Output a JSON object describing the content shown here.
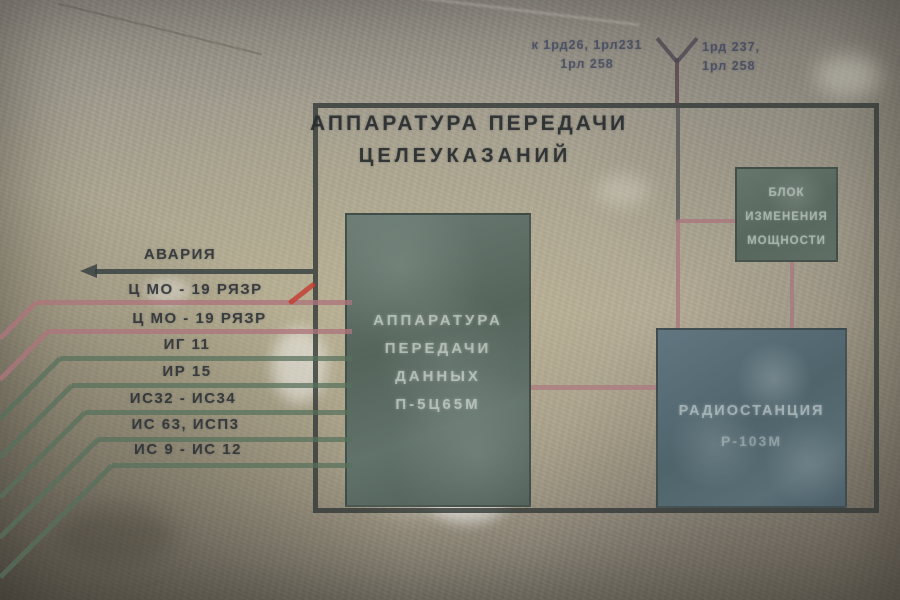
{
  "meta": {
    "description": "Photograph of a schematic diagram stencil-painted on a concrete bunker wall",
    "language": "Russian"
  },
  "title": {
    "line1": "АППАРАТУРА ПЕРЕДАЧИ",
    "line2": "ЦЕЛЕУКАЗАНИЙ"
  },
  "antenna_labels": {
    "left": {
      "line1": "к 1рд26, 1рл231",
      "line2": "1рл 258"
    },
    "right": {
      "line1": "1рд 237,",
      "line2": "1рл 258"
    }
  },
  "boxes": {
    "data_apparatus": {
      "lines": [
        "АППАРАТУРА",
        "ПЕРЕДАЧИ",
        "ДАННЫХ",
        "П-5Ц65М"
      ]
    },
    "power_block": {
      "lines": [
        "БЛОК",
        "ИЗМЕНЕНИЯ",
        "МОЩНОСТИ"
      ]
    },
    "radio_station": {
      "lines": [
        "РАДИОСТАНЦИЯ",
        "Р-103М"
      ]
    }
  },
  "channels": [
    {
      "label": "АВАРИЯ",
      "line_color": "#34403f",
      "style": "dark-arrow-left"
    },
    {
      "label": "Ц МО - 19 РЯЗР",
      "line_color": "#ad747c",
      "style": "pink"
    },
    {
      "label": "Ц МО - 19 РЯЗР",
      "line_color": "#ad747c",
      "style": "pink"
    },
    {
      "label": "ИГ 11",
      "line_color": "#56705c",
      "style": "green"
    },
    {
      "label": "ИР 15",
      "line_color": "#56705c",
      "style": "green"
    },
    {
      "label": "ИС32 - ИС34",
      "line_color": "#56705c",
      "style": "green"
    },
    {
      "label": "ИС 63, ИСП3",
      "line_color": "#56705c",
      "style": "green"
    },
    {
      "label": "ИС 9 - ИС 12",
      "line_color": "#56705c",
      "style": "green"
    }
  ],
  "palette": {
    "wall": "#a8a291",
    "frame": "#303634",
    "stencil_dark": "#2b3036",
    "stencil_light": "#c5d0c8",
    "box_green": "#5a6c64",
    "box_blue": "#57696e",
    "pink_line": "#aa767e",
    "green_line": "#56705c",
    "red_mark": "#c53a2e"
  }
}
